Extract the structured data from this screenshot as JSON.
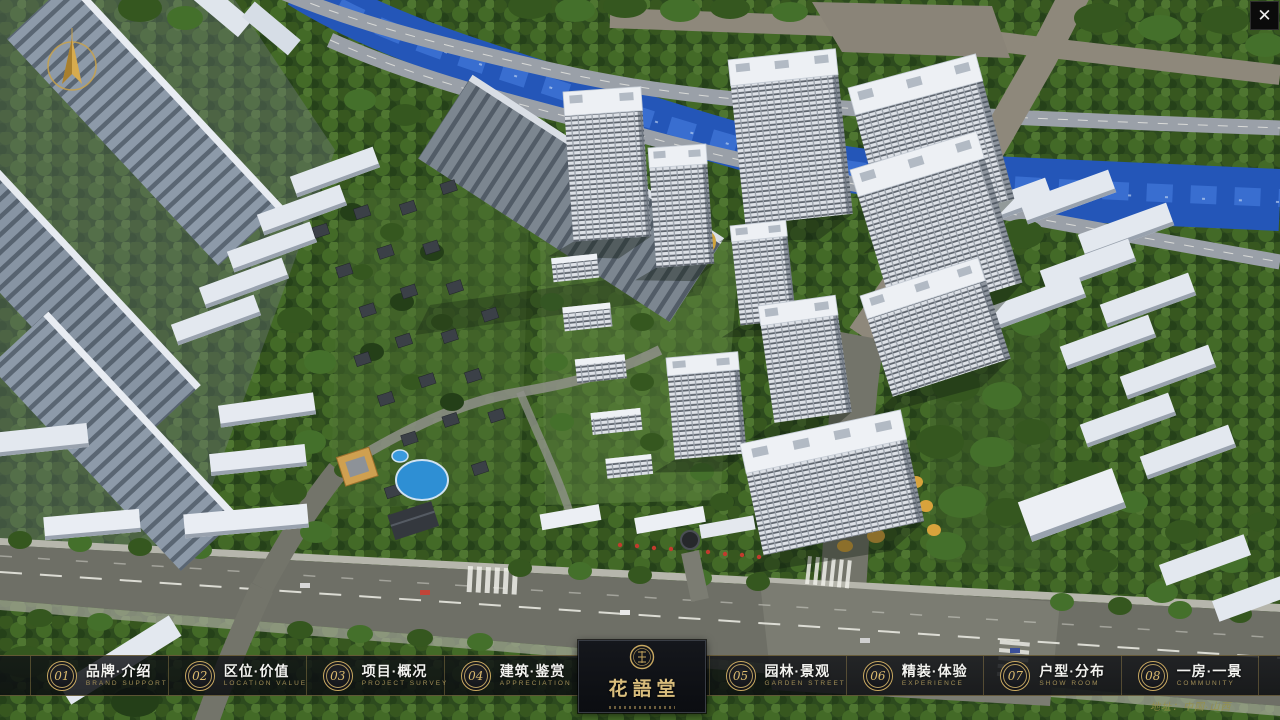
{
  "icons": {
    "close": "✕"
  },
  "logo": {
    "title": "花語堂"
  },
  "nav": {
    "items": [
      {
        "num": "01",
        "label": "品牌·介绍",
        "sub": "BRAND SUPPORT"
      },
      {
        "num": "02",
        "label": "区位·价值",
        "sub": "LOCATION VALUE"
      },
      {
        "num": "03",
        "label": "项目·概况",
        "sub": "PROJECT SURVEY"
      },
      {
        "num": "04",
        "label": "建筑·鉴赏",
        "sub": "APPRECIATION"
      },
      {
        "num": "05",
        "label": "园林·景观",
        "sub": "GARDEN STREET"
      },
      {
        "num": "06",
        "label": "精装·体验",
        "sub": "EXPERIENCE"
      },
      {
        "num": "07",
        "label": "户型·分布",
        "sub": "SHOW ROOM"
      },
      {
        "num": "08",
        "label": "一房·一景",
        "sub": "COMMUNITY"
      }
    ]
  },
  "footer": {
    "address": "地址：中国·山西"
  }
}
